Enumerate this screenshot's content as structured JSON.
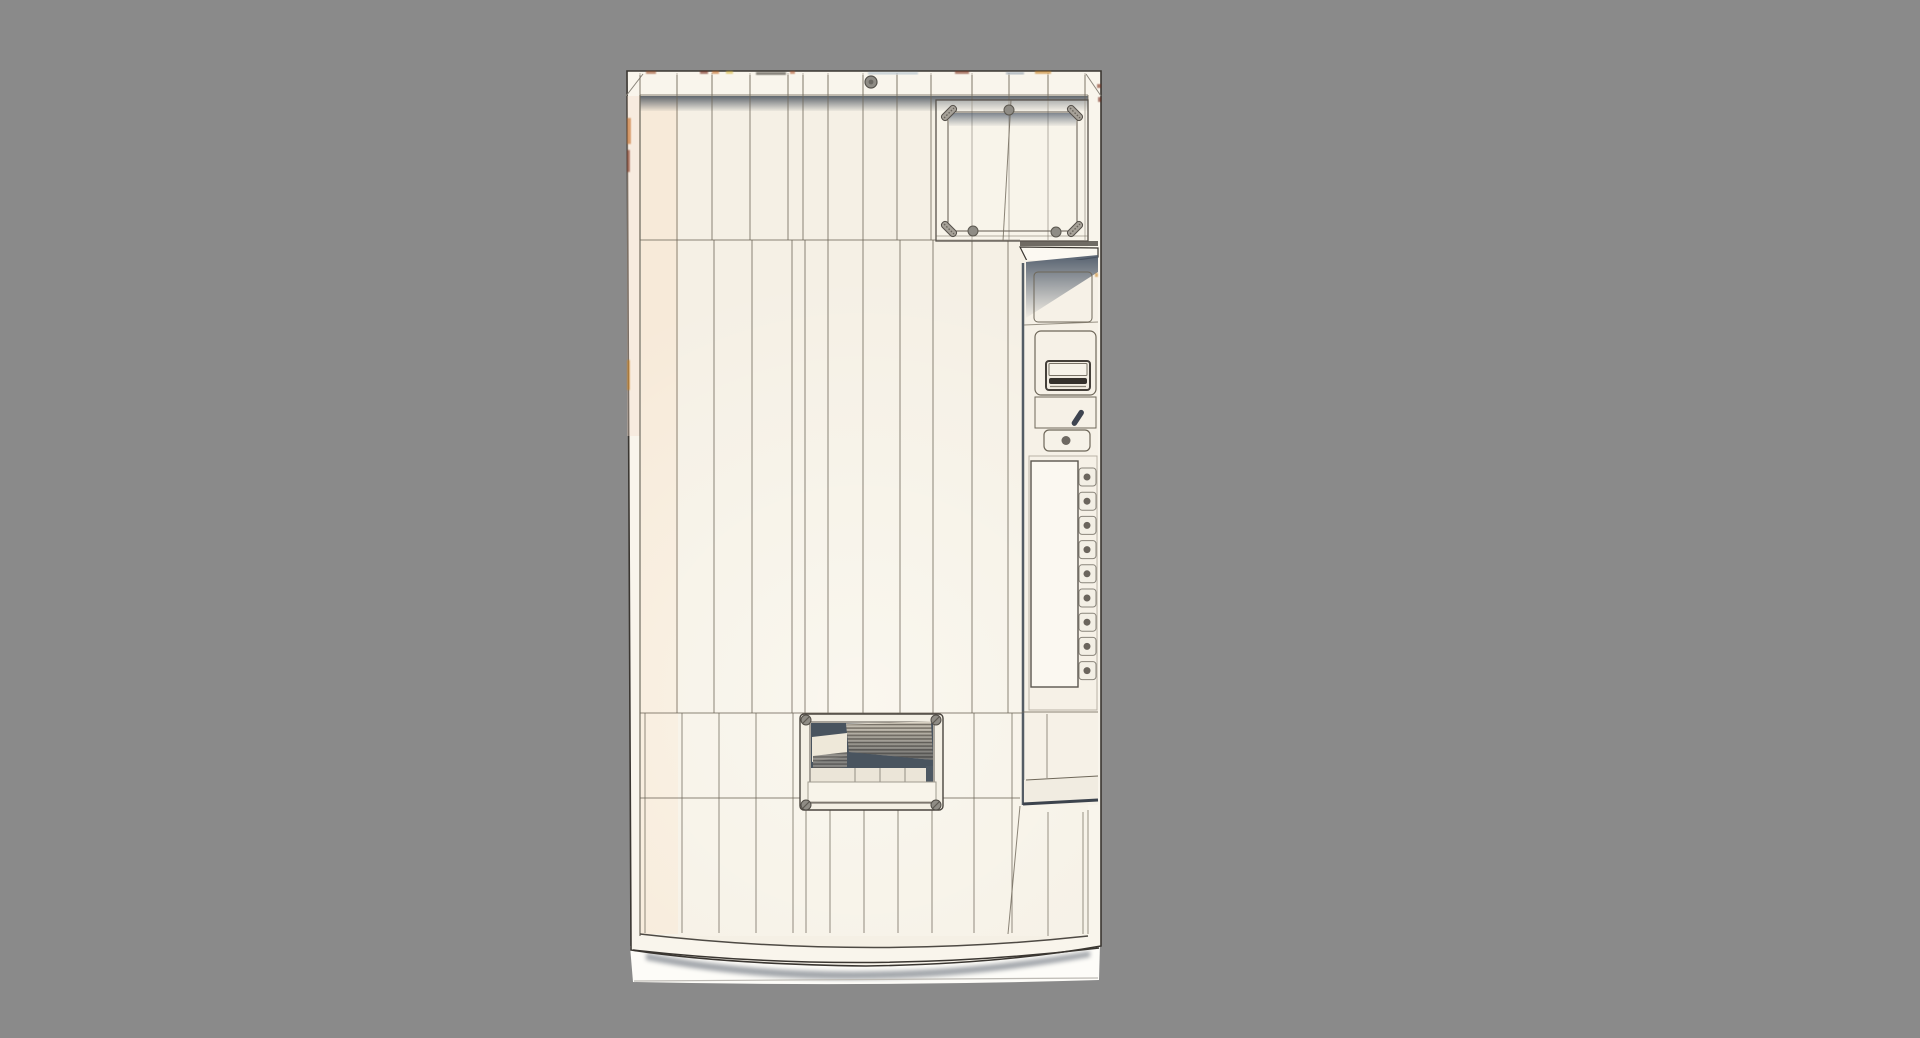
{
  "meta": {
    "description": "3D shaded-wireframe render of a vintage vending machine front panel, viewed straight on, floating over a neutral gray studio backdrop",
    "render_mode": "shaded wireframe",
    "visible_text": ""
  },
  "canvas": {
    "width": 1920,
    "height": 1038
  },
  "colors": {
    "background": "#8a8a8a",
    "body": "#f9f5ec",
    "face": "#f5f0e5",
    "face_warm": "#f7e5d0",
    "wireframe": "#6e6759",
    "outline": "#3a3631",
    "frame_dark": "#57524b",
    "shadow_blue": "#4c5868",
    "interior_dark": "#49545f",
    "metal_light": "#d2ccbe",
    "metal_dark": "#6e685d",
    "screw": "#8f8c85",
    "apron": "#fdfcf8",
    "ground_shadow": "#5a626e",
    "lever": "#3e4450",
    "slot": "#35312c",
    "seam_artifact_palette": [
      "#6d1b0d",
      "#c2661c",
      "#d8b83a",
      "#34302b",
      "#b3542a",
      "#a7bac9",
      "#7a2a12",
      "#c8801f",
      "#8898a8",
      "#9a4a20"
    ]
  },
  "machine": {
    "name": "vending-machine",
    "components": {
      "marquee_window": {
        "label": "sign window",
        "screw_count": 3,
        "corner_clamp_count": 4
      },
      "top_bolt": {
        "count": 1
      },
      "service_column": {
        "acceptor": {
          "label": "bill-coin acceptor"
        },
        "coin_return_lever": {
          "label": "coin return lever"
        },
        "coin_return_button": {
          "label": "coin return button"
        },
        "selection_panel": {
          "label": "selection buttons",
          "button_count": 9,
          "label_strip_count": 1
        }
      },
      "delivery_door": {
        "label": "product delivery door",
        "corner_bolt_count": 4,
        "flap": "ribbed metal flap"
      }
    }
  }
}
